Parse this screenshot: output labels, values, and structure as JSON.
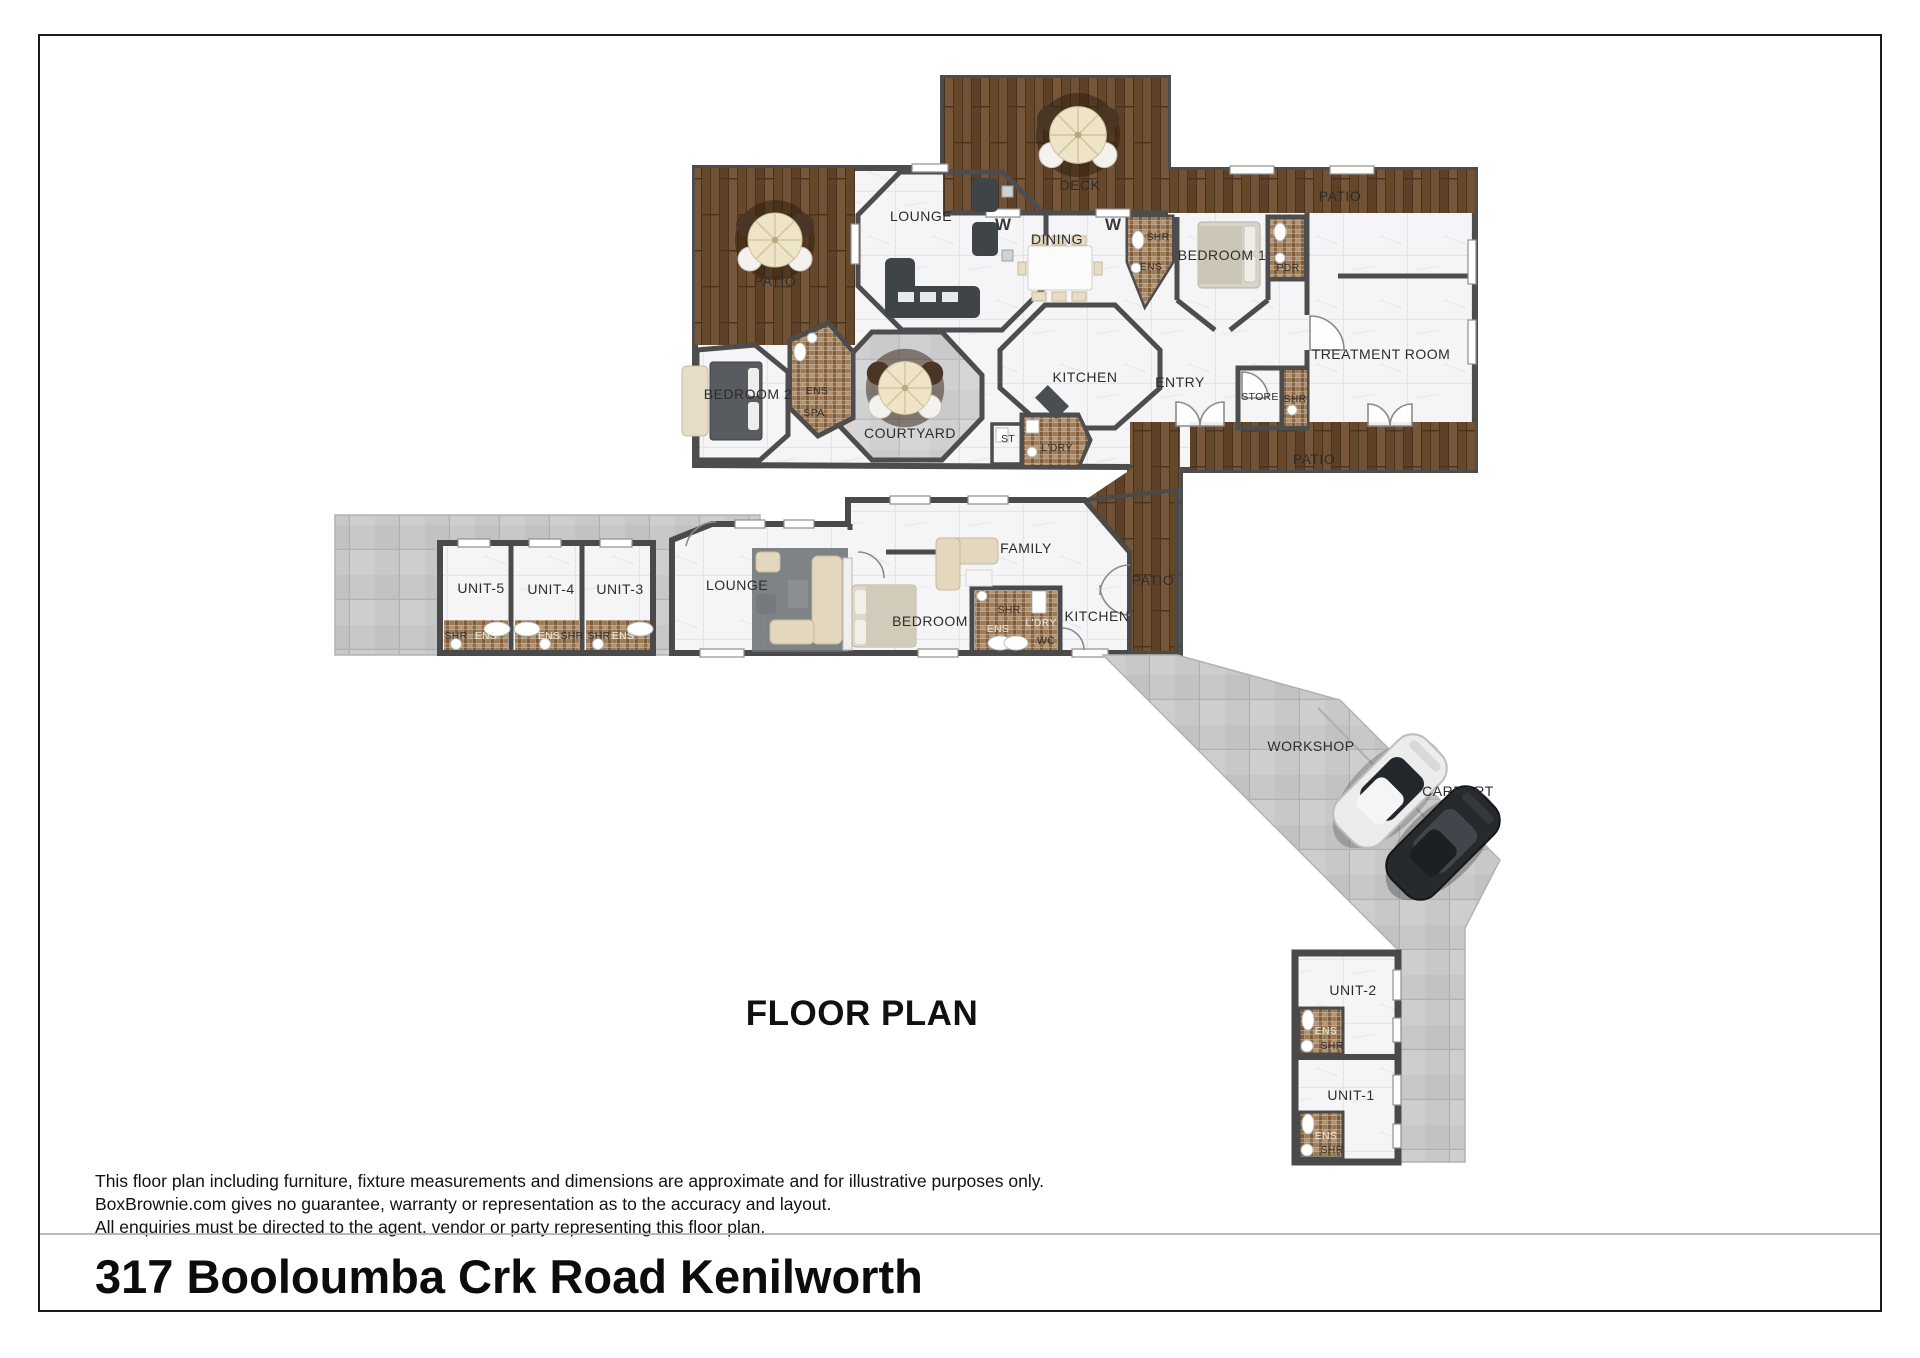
{
  "page": {
    "title": "FLOOR PLAN",
    "address": "317 Booloumba Crk Road Kenilworth",
    "disclaimer_lines": [
      "This floor plan including furniture, fixture measurements and dimensions are approximate and for illustrative purposes only.",
      "BoxBrownie.com gives no guarantee, warranty or representation as to the accuracy and layout.",
      "All enquiries must be directed to the agent, vendor or party representing this floor plan."
    ]
  },
  "icons": {
    "umbrella_table": "outdoor-umbrella-table",
    "white_car": "white-car",
    "black_car": "black-car"
  },
  "labels": {
    "deck": "DECK",
    "patio_top_left": "PATIO",
    "lounge_main": "LOUNGE",
    "dining": "DINING",
    "shr_dining": "SHR",
    "ens_dining": "ENS",
    "bedroom1": "BEDROOM 1",
    "pdr": "PDR",
    "patio_top_right": "PATIO",
    "treatment_room": "TREATMENT ROOM",
    "entry": "ENTRY",
    "kitchen_main": "KITCHEN",
    "store": "STORE",
    "shr_store": "SHR",
    "patio_bottom": "PATIO",
    "bedroom2": "BEDROOM 2",
    "ens_spa": "ENS",
    "spa": "SPA",
    "courtyard": "COURTYARD",
    "st": "ST",
    "ldry_main": "L'DRY",
    "window_mark": "W",
    "unit5": "UNIT-5",
    "unit4": "UNIT-4",
    "unit3": "UNIT-3",
    "u5_shr": "SHR",
    "u5_ens": "ENS",
    "u4_ens": "ENS",
    "u4_shr": "SHR",
    "u3_shr": "SHR",
    "u3_ens": "ENS",
    "lounge2": "LOUNGE",
    "bedroom3": "BEDROOM",
    "family": "FAMILY",
    "shr2": "SHR",
    "ens2": "ENS",
    "ldry2": "L'DRY",
    "wc": "WC",
    "kitchen2": "KITCHEN",
    "patio2": "PATIO",
    "workshop": "WORKSHOP",
    "carport": "CARPORT",
    "unit2": "UNIT-2",
    "unit1": "UNIT-1",
    "u2_ens": "ENS",
    "u2_shr": "SHR",
    "u1_ens": "ENS",
    "u1_shr": "SHR"
  }
}
